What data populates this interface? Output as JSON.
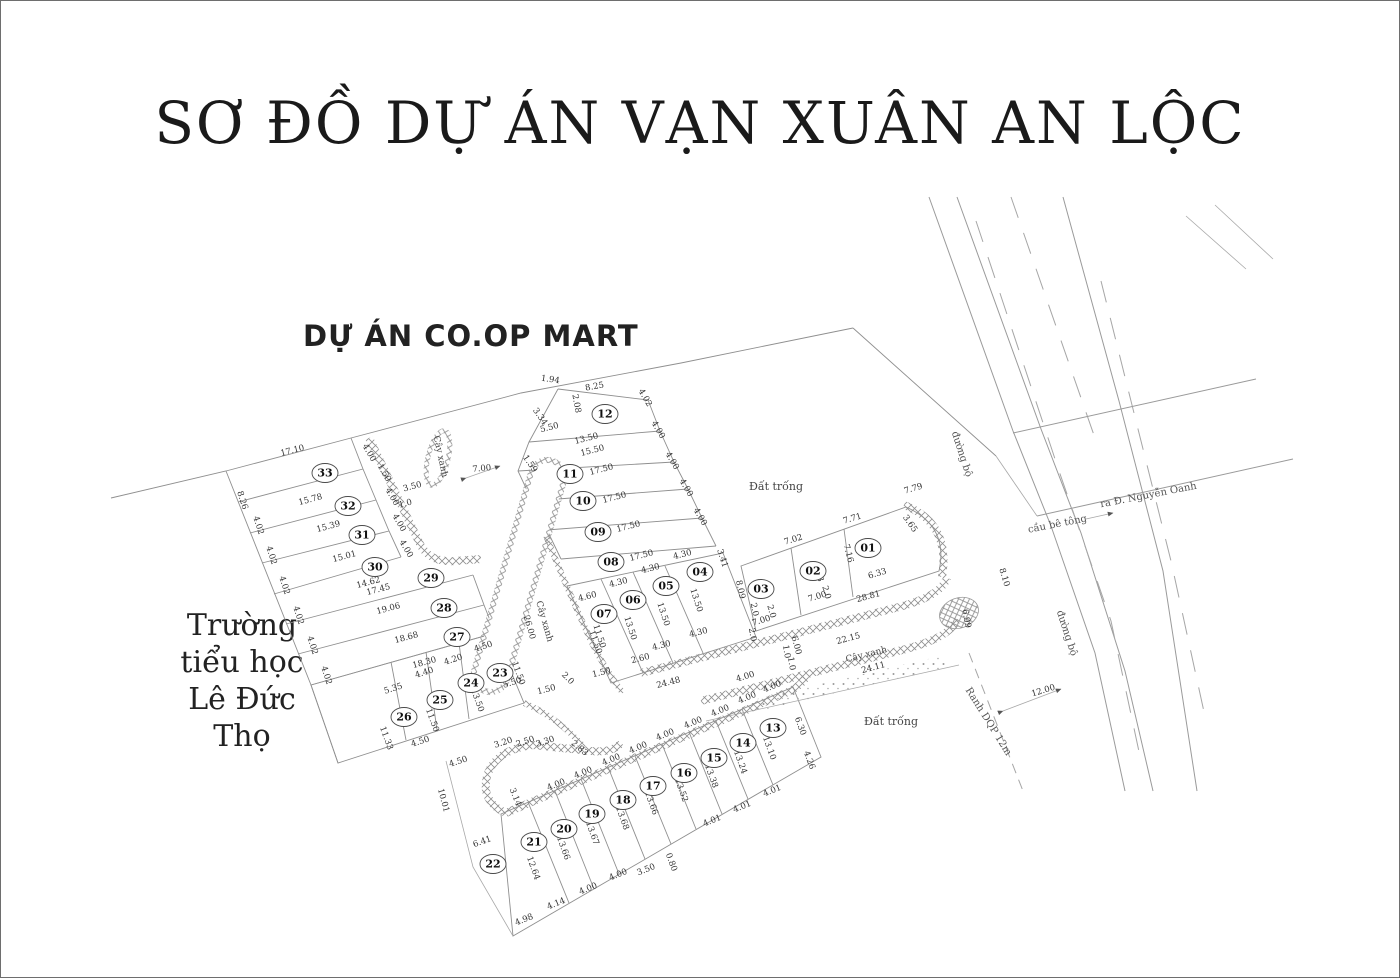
{
  "page": {
    "title": "SƠ ĐỒ DỰ ÁN VẠN XUÂN AN LỘC",
    "coopmart_label": "DỰ ÁN CO.OP MART",
    "school_label": "Trường\ntiểu học\nLê Đức\nThọ"
  },
  "map": {
    "lots": [
      {
        "id": "01",
        "x": 867,
        "y": 547
      },
      {
        "id": "02",
        "x": 812,
        "y": 570
      },
      {
        "id": "03",
        "x": 760,
        "y": 588
      },
      {
        "id": "04",
        "x": 699,
        "y": 571
      },
      {
        "id": "05",
        "x": 665,
        "y": 585
      },
      {
        "id": "06",
        "x": 632,
        "y": 599
      },
      {
        "id": "07",
        "x": 603,
        "y": 613
      },
      {
        "id": "08",
        "x": 610,
        "y": 561
      },
      {
        "id": "09",
        "x": 597,
        "y": 531
      },
      {
        "id": "10",
        "x": 582,
        "y": 500
      },
      {
        "id": "11",
        "x": 569,
        "y": 473
      },
      {
        "id": "12",
        "x": 604,
        "y": 413
      },
      {
        "id": "13",
        "x": 772,
        "y": 727
      },
      {
        "id": "14",
        "x": 742,
        "y": 742
      },
      {
        "id": "15",
        "x": 713,
        "y": 757
      },
      {
        "id": "16",
        "x": 683,
        "y": 772
      },
      {
        "id": "17",
        "x": 652,
        "y": 785
      },
      {
        "id": "18",
        "x": 622,
        "y": 799
      },
      {
        "id": "19",
        "x": 591,
        "y": 813
      },
      {
        "id": "20",
        "x": 563,
        "y": 828
      },
      {
        "id": "21",
        "x": 533,
        "y": 841
      },
      {
        "id": "22",
        "x": 492,
        "y": 863
      },
      {
        "id": "23",
        "x": 499,
        "y": 672
      },
      {
        "id": "24",
        "x": 470,
        "y": 682
      },
      {
        "id": "25",
        "x": 439,
        "y": 699
      },
      {
        "id": "26",
        "x": 403,
        "y": 716
      },
      {
        "id": "27",
        "x": 456,
        "y": 636
      },
      {
        "id": "28",
        "x": 443,
        "y": 607
      },
      {
        "id": "29",
        "x": 430,
        "y": 577
      },
      {
        "id": "30",
        "x": 374,
        "y": 566
      },
      {
        "id": "31",
        "x": 361,
        "y": 534
      },
      {
        "id": "32",
        "x": 347,
        "y": 505
      },
      {
        "id": "33",
        "x": 324,
        "y": 472
      }
    ],
    "dims": [
      [
        "17.10",
        292,
        452,
        -14
      ],
      [
        "15.78",
        310,
        501,
        -15
      ],
      [
        "15.39",
        328,
        528,
        -15
      ],
      [
        "15.01",
        344,
        558,
        -15
      ],
      [
        "14.62",
        368,
        584,
        -15
      ],
      [
        "17.45",
        378,
        591,
        -15
      ],
      [
        "19.06",
        388,
        610,
        -15
      ],
      [
        "18.68",
        406,
        639,
        -15
      ],
      [
        "18.30",
        424,
        664,
        -15
      ],
      [
        "8.26",
        239,
        500,
        72
      ],
      [
        "4.02",
        255,
        525,
        72
      ],
      [
        "4.02",
        268,
        555,
        72
      ],
      [
        "4.02",
        281,
        585,
        72
      ],
      [
        "4.02",
        295,
        615,
        72
      ],
      [
        "4.02",
        309,
        645,
        72
      ],
      [
        "4.02",
        323,
        675,
        72
      ],
      [
        "4.00",
        366,
        453,
        60
      ],
      [
        "1.50",
        381,
        473,
        60
      ],
      [
        "4.00",
        389,
        497,
        60
      ],
      [
        "4.00",
        396,
        523,
        60
      ],
      [
        "4.00",
        403,
        549,
        60
      ],
      [
        "3.50",
        412,
        488,
        -15
      ],
      [
        "1.0",
        405,
        505,
        -15
      ],
      [
        "5.35",
        393,
        690,
        -18
      ],
      [
        "4.40",
        424,
        674,
        -18
      ],
      [
        "4.20",
        453,
        661,
        -18
      ],
      [
        "4.50",
        483,
        648,
        -18
      ],
      [
        "11.33",
        383,
        738,
        70
      ],
      [
        "11.50",
        429,
        720,
        70
      ],
      [
        "13.50",
        474,
        700,
        70
      ],
      [
        "11.50",
        515,
        673,
        70
      ],
      [
        "11.50",
        592,
        642,
        70
      ],
      [
        "5.50",
        512,
        684,
        -18
      ],
      [
        "4.50",
        420,
        743,
        -18
      ],
      [
        "4.50",
        458,
        763,
        -18
      ],
      [
        "3.20",
        503,
        744,
        -18
      ],
      [
        "2.50",
        525,
        743,
        -18
      ],
      [
        "3.30",
        545,
        743,
        -18
      ],
      [
        "2.83",
        577,
        749,
        40
      ],
      [
        "1.94",
        549,
        381,
        8
      ],
      [
        "8.25",
        594,
        388,
        -10
      ],
      [
        "2.08",
        573,
        403,
        80
      ],
      [
        "3.34",
        537,
        417,
        55
      ],
      [
        "5.50",
        549,
        429,
        -14
      ],
      [
        "13.50",
        586,
        440,
        -14
      ],
      [
        "15.50",
        592,
        452,
        -14
      ],
      [
        "17.50",
        601,
        471,
        -14
      ],
      [
        "17.50",
        614,
        499,
        -14
      ],
      [
        "17.50",
        628,
        528,
        -14
      ],
      [
        "17.50",
        641,
        557,
        -14
      ],
      [
        "4.02",
        642,
        398,
        60
      ],
      [
        "4.00",
        655,
        430,
        60
      ],
      [
        "4.00",
        669,
        461,
        60
      ],
      [
        "4.00",
        683,
        488,
        60
      ],
      [
        "4.00",
        697,
        517,
        60
      ],
      [
        "3.41",
        719,
        558,
        72
      ],
      [
        "1.59",
        527,
        464,
        55
      ],
      [
        "7.00",
        481,
        470,
        -5
      ],
      [
        "4.60",
        587,
        598,
        -14
      ],
      [
        "4.30",
        618,
        584,
        -14
      ],
      [
        "4.30",
        650,
        570,
        -14
      ],
      [
        "4.30",
        682,
        556,
        -14
      ],
      [
        "13.50",
        693,
        600,
        72
      ],
      [
        "13.50",
        660,
        614,
        72
      ],
      [
        "13.50",
        627,
        628,
        72
      ],
      [
        "11.50",
        596,
        636,
        72
      ],
      [
        "2.60",
        640,
        660,
        -14
      ],
      [
        "4.30",
        661,
        647,
        -14
      ],
      [
        "4.30",
        698,
        634,
        -14
      ],
      [
        "24.48",
        668,
        684,
        -14
      ],
      [
        "2.0",
        565,
        679,
        45
      ],
      [
        "1.50",
        546,
        691,
        -14
      ],
      [
        "1.50",
        601,
        674,
        -14
      ],
      [
        "8.09",
        737,
        589,
        78
      ],
      [
        "2.0",
        751,
        609,
        78
      ],
      [
        "7.02",
        793,
        541,
        -17
      ],
      [
        "7.71",
        852,
        520,
        -17
      ],
      [
        "7.79",
        913,
        490,
        -17
      ],
      [
        "7.16",
        845,
        553,
        75
      ],
      [
        "7.63",
        815,
        572,
        75
      ],
      [
        "3.65",
        907,
        524,
        55
      ],
      [
        "6.33",
        877,
        575,
        -17
      ],
      [
        "2.0",
        823,
        592,
        75
      ],
      [
        "2.0",
        768,
        611,
        75
      ],
      [
        "7.00",
        817,
        598,
        -17
      ],
      [
        "7.00",
        761,
        622,
        -17
      ],
      [
        "28.81",
        868,
        598,
        -15
      ],
      [
        "6.99",
        963,
        618,
        80
      ],
      [
        "6.00",
        793,
        645,
        75
      ],
      [
        "1.0",
        783,
        651,
        80
      ],
      [
        "1.0",
        788,
        663,
        80
      ],
      [
        "2.0",
        749,
        634,
        80
      ],
      [
        "4.00",
        745,
        678,
        -17
      ],
      [
        "22.15",
        848,
        640,
        -15
      ],
      [
        "24.11",
        873,
        669,
        -15
      ],
      [
        "4.00",
        556,
        786,
        -22
      ],
      [
        "4.00",
        583,
        774,
        -22
      ],
      [
        "4.00",
        611,
        761,
        -22
      ],
      [
        "4.00",
        638,
        749,
        -22
      ],
      [
        "4.00",
        665,
        736,
        -22
      ],
      [
        "4.00",
        693,
        724,
        -22
      ],
      [
        "4.00",
        720,
        712,
        -22
      ],
      [
        "4.00",
        747,
        699,
        -22
      ],
      [
        "4.00",
        772,
        688,
        -22
      ],
      [
        "12.64",
        530,
        868,
        70
      ],
      [
        "13.66",
        560,
        848,
        70
      ],
      [
        "13.67",
        589,
        833,
        70
      ],
      [
        "13.68",
        619,
        818,
        70
      ],
      [
        "13.66",
        648,
        803,
        70
      ],
      [
        "13.52",
        678,
        790,
        70
      ],
      [
        "13.38",
        708,
        776,
        70
      ],
      [
        "13.24",
        737,
        762,
        70
      ],
      [
        "13.10",
        766,
        748,
        70
      ],
      [
        "6.30",
        797,
        726,
        70
      ],
      [
        "4.26",
        806,
        760,
        70
      ],
      [
        "4.01",
        712,
        822,
        -22
      ],
      [
        "4.01",
        742,
        808,
        -22
      ],
      [
        "4.01",
        772,
        792,
        -22
      ],
      [
        "0.80",
        668,
        862,
        70
      ],
      [
        "3.50",
        646,
        871,
        -22
      ],
      [
        "4.98",
        524,
        921,
        -22
      ],
      [
        "4.14",
        556,
        905,
        -22
      ],
      [
        "4.00",
        588,
        890,
        -22
      ],
      [
        "4.00",
        618,
        876,
        -22
      ],
      [
        "6.41",
        482,
        843,
        -20
      ],
      [
        "10.01",
        440,
        800,
        75
      ],
      [
        "3.14",
        512,
        797,
        68
      ],
      [
        "8.10",
        1001,
        577,
        73
      ],
      [
        "12.00",
        1043,
        692,
        -17
      ],
      [
        "26.00",
        526,
        627,
        74
      ]
    ],
    "areas": [
      {
        "text": "Đất trống",
        "x": 775,
        "y": 489,
        "r": 0,
        "cls": "area"
      },
      {
        "text": "Đất trống",
        "x": 890,
        "y": 724,
        "r": 0,
        "cls": "area"
      },
      {
        "text": "Cây xanh",
        "x": 437,
        "y": 456,
        "r": 78,
        "cls": "green"
      },
      {
        "text": "Cây xanh",
        "x": 541,
        "y": 621,
        "r": 74,
        "cls": "green"
      },
      {
        "text": "Cây xanh",
        "x": 866,
        "y": 656,
        "r": -14,
        "cls": "green"
      },
      {
        "text": "đường bộ",
        "x": 958,
        "y": 454,
        "r": 72,
        "cls": "roadlbl"
      },
      {
        "text": "đường bộ",
        "x": 1063,
        "y": 633,
        "r": 72,
        "cls": "roadlbl"
      },
      {
        "text": "cầu bê tông",
        "x": 1057,
        "y": 526,
        "r": -11,
        "cls": "roadlbl"
      },
      {
        "text": "ra Đ. Nguyễn Oanh",
        "x": 1148,
        "y": 497,
        "r": -11,
        "cls": "roadlbl"
      },
      {
        "text": "Ranh DQP 12m",
        "x": 985,
        "y": 722,
        "r": 58,
        "cls": "roadlbl"
      }
    ]
  }
}
